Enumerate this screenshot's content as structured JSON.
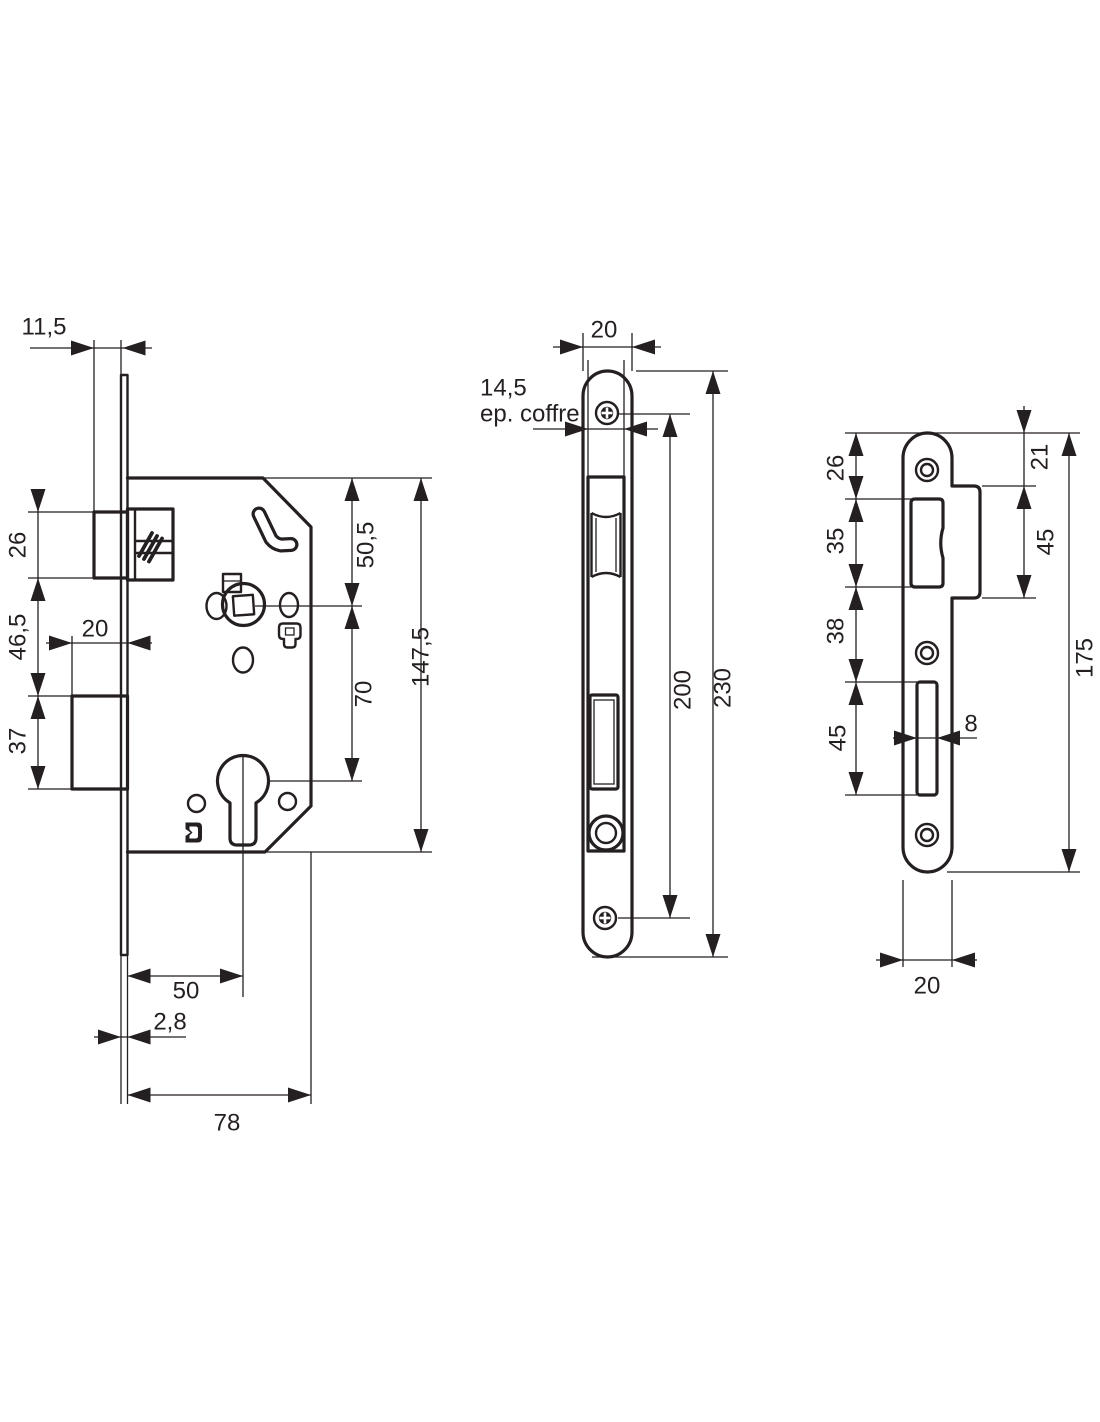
{
  "drawing": {
    "background": "#ffffff",
    "line_color": "#241f21",
    "views": {
      "lock_body": {
        "name": "mortise lock body side view",
        "dims": {
          "faceplate_to_latch": "11,5",
          "latch_height": "26",
          "latch_to_deadbolt": "46,5",
          "deadbolt_height": "37",
          "deadbolt_throw": "20",
          "top_to_follower": "50,5",
          "follower_to_cylinder": "70",
          "case_height": "147,5",
          "backset": "50",
          "faceplate_thickness": "2,8",
          "case_depth": "78"
        }
      },
      "faceplate": {
        "name": "faceplate front view",
        "dims": {
          "width": "20",
          "case_thickness": "14,5",
          "case_thickness_label": "ep. coffre",
          "screw_spacing": "200",
          "height": "230"
        }
      },
      "strike_plate": {
        "name": "strike plate front view",
        "dims": {
          "top_to_latch_opening": "26",
          "latch_opening_height": "35",
          "latch_to_slot_gap": "38",
          "slot_height": "45",
          "top_to_tab": "21",
          "tab_height": "45",
          "slot_width": "8",
          "height": "175",
          "width": "20"
        }
      }
    }
  }
}
